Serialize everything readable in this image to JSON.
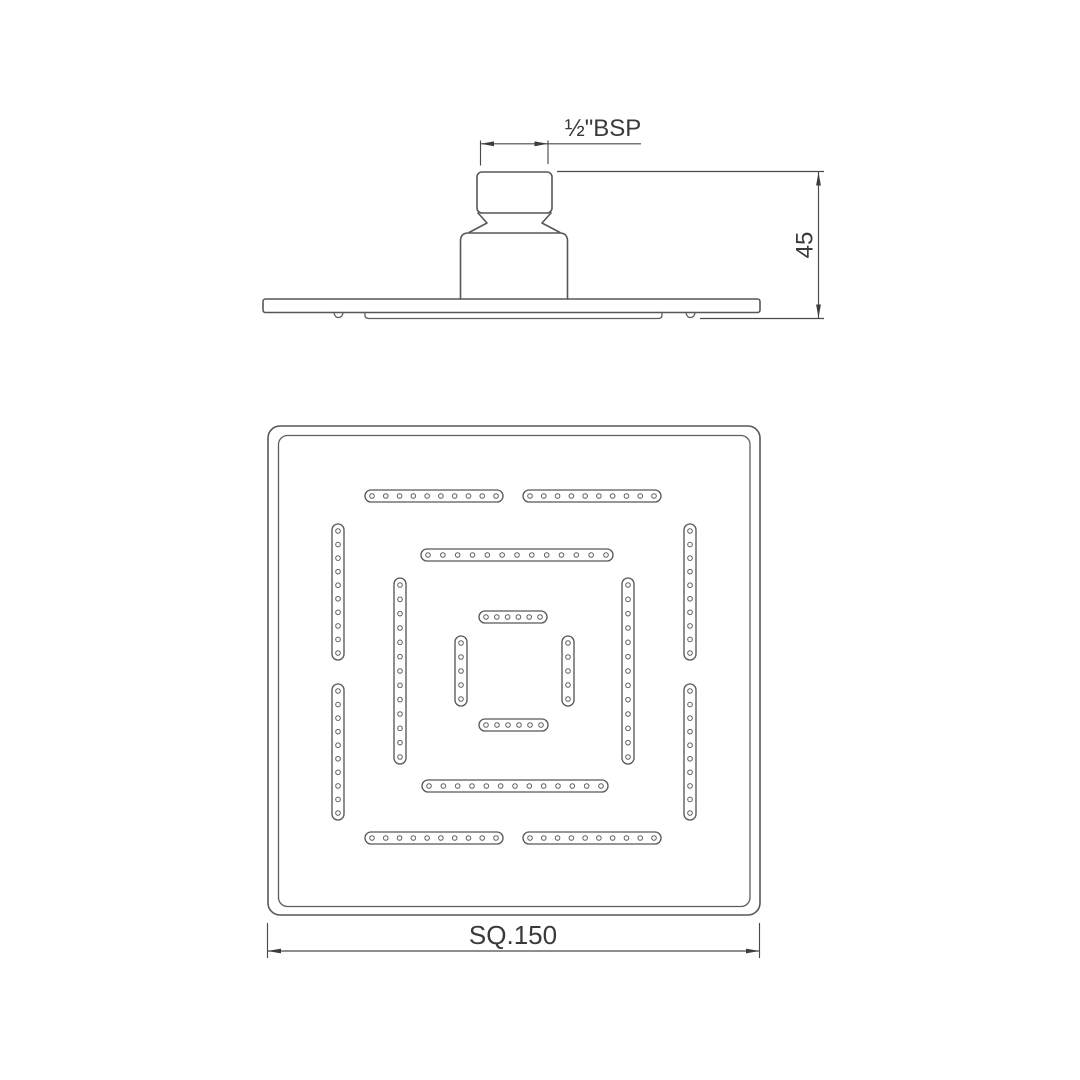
{
  "drawing": {
    "background": "#ffffff",
    "line_color": "#575757",
    "dimension_color": "#4a4a4a",
    "text_color": "#3a3a3a"
  },
  "side_view": {
    "thread_dim": {
      "label": "½\"BSP"
    },
    "height_dim": {
      "label": "45"
    }
  },
  "bottom_view": {
    "size_dim": {
      "label": "SQ.150"
    },
    "nozzle_slots": [
      {
        "ring": "outer",
        "dir": "h",
        "x": 365,
        "y": 490,
        "len": 138,
        "holes": 10
      },
      {
        "ring": "outer",
        "dir": "h",
        "x": 523,
        "y": 490,
        "len": 138,
        "holes": 10
      },
      {
        "ring": "outer",
        "dir": "v",
        "x": 332,
        "y": 524,
        "len": 136,
        "holes": 10
      },
      {
        "ring": "outer",
        "dir": "v",
        "x": 332,
        "y": 684,
        "len": 136,
        "holes": 10
      },
      {
        "ring": "outer",
        "dir": "v",
        "x": 684,
        "y": 524,
        "len": 136,
        "holes": 10
      },
      {
        "ring": "outer",
        "dir": "v",
        "x": 684,
        "y": 684,
        "len": 136,
        "holes": 10
      },
      {
        "ring": "outer",
        "dir": "h",
        "x": 365,
        "y": 832,
        "len": 138,
        "holes": 10
      },
      {
        "ring": "outer",
        "dir": "h",
        "x": 523,
        "y": 832,
        "len": 138,
        "holes": 10
      },
      {
        "ring": "middle",
        "dir": "h",
        "x": 421,
        "y": 549,
        "len": 192,
        "holes": 13
      },
      {
        "ring": "middle",
        "dir": "v",
        "x": 394,
        "y": 578,
        "len": 186,
        "holes": 13
      },
      {
        "ring": "middle",
        "dir": "v",
        "x": 622,
        "y": 578,
        "len": 186,
        "holes": 13
      },
      {
        "ring": "middle",
        "dir": "h",
        "x": 422,
        "y": 780,
        "len": 186,
        "holes": 13
      },
      {
        "ring": "inner",
        "dir": "h",
        "x": 479,
        "y": 611,
        "len": 68,
        "holes": 6
      },
      {
        "ring": "inner",
        "dir": "h",
        "x": 479,
        "y": 719,
        "len": 69,
        "holes": 6
      },
      {
        "ring": "inner",
        "dir": "v",
        "x": 455,
        "y": 636,
        "len": 70,
        "holes": 5
      },
      {
        "ring": "inner",
        "dir": "v",
        "x": 562,
        "y": 636,
        "len": 70,
        "holes": 5
      }
    ]
  }
}
